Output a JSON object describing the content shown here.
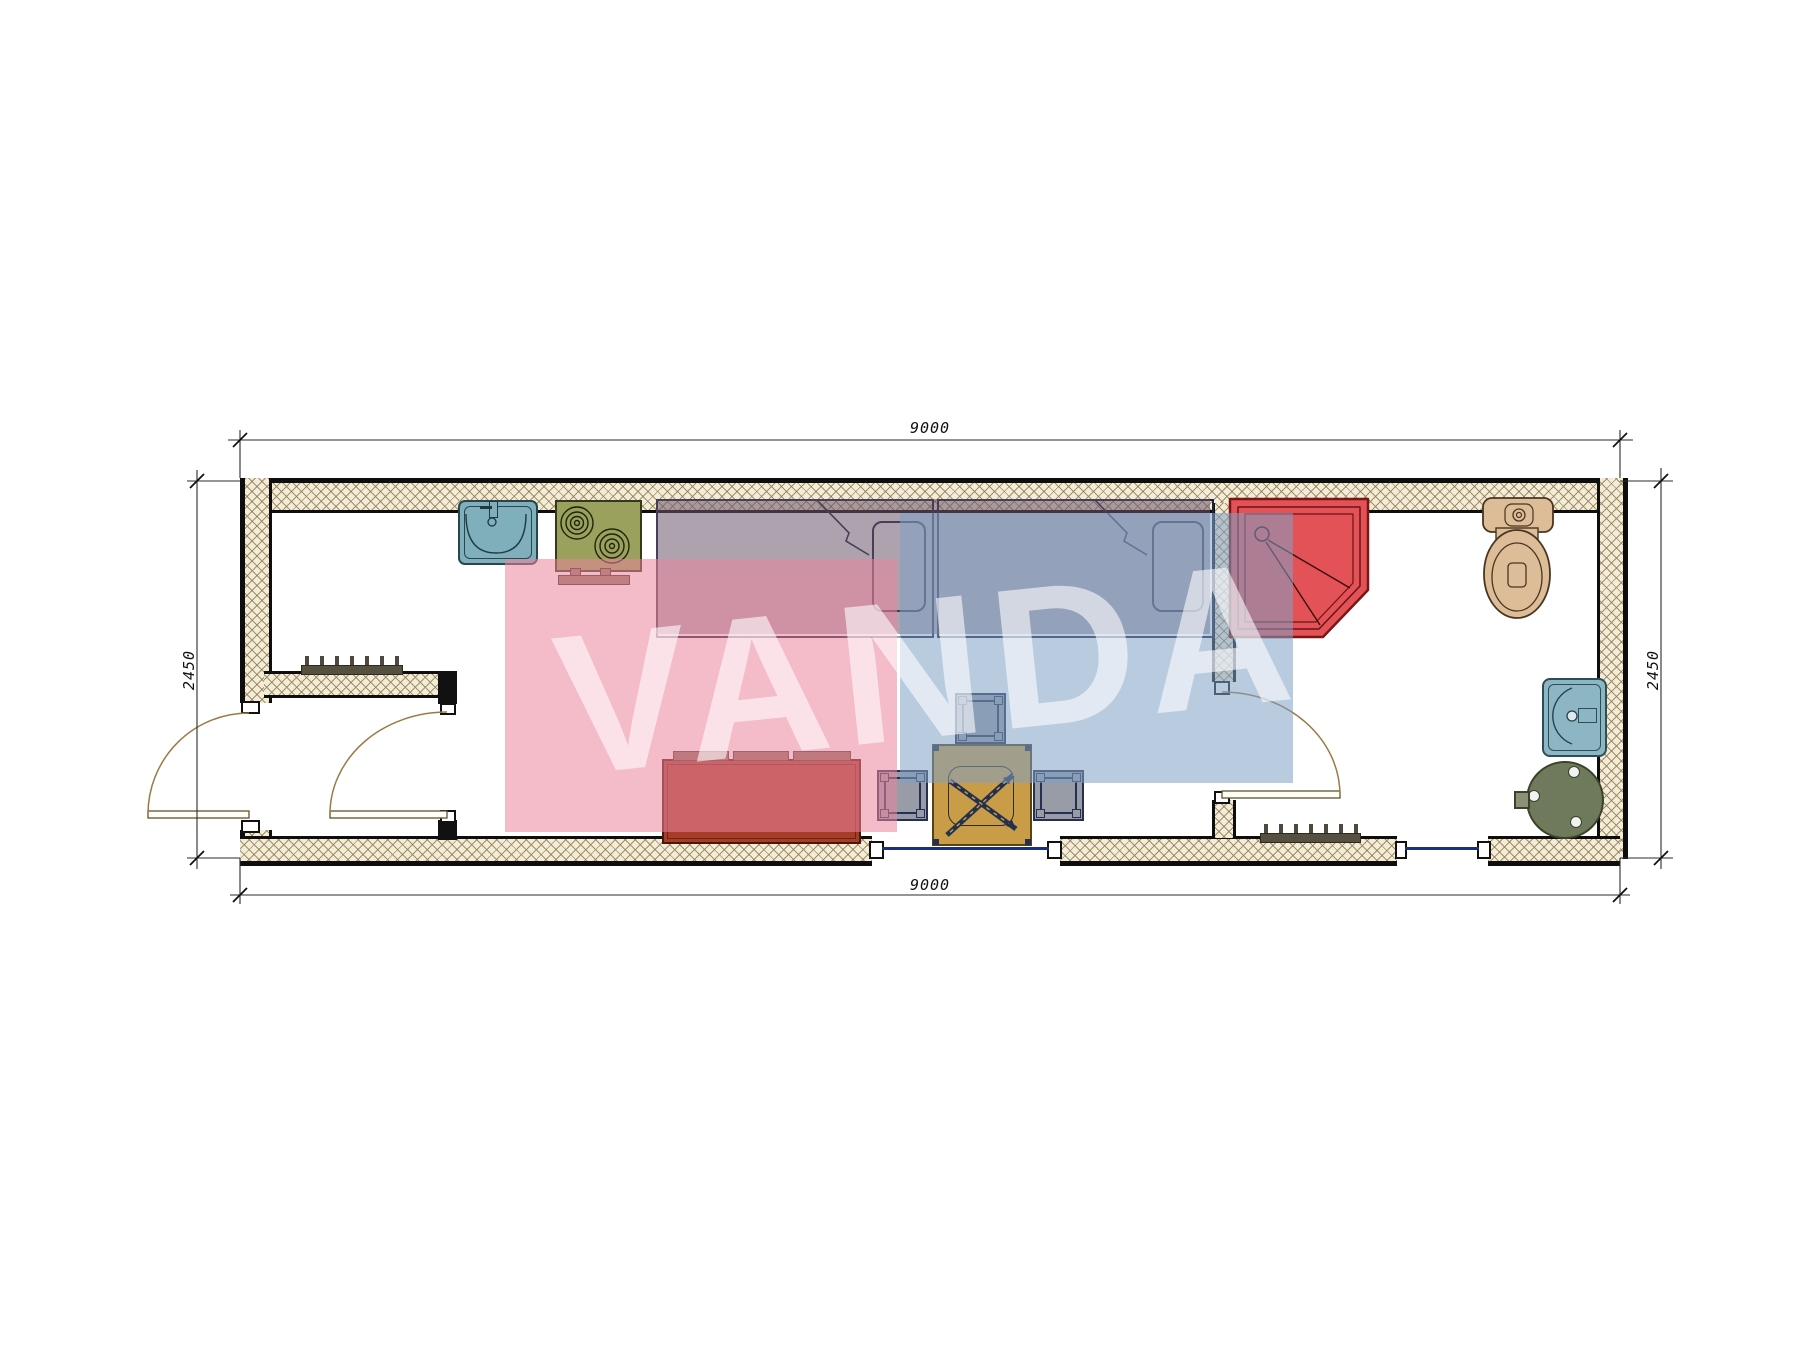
{
  "watermark": {
    "text": "VANDA",
    "pink_color": "#eb839d",
    "blue_color": "#80a0c5"
  },
  "dimensions": {
    "width_top": "9000",
    "width_bottom": "9000",
    "height_left": "2450",
    "height_right": "2450"
  },
  "plan": {
    "type": "container-house-floor-plan",
    "rooms": [
      "entry-hall",
      "kitchen-living-bedroom",
      "bathroom"
    ],
    "furniture": [
      "kitchen-sink",
      "stove-two-burners",
      "single-bed-1",
      "single-bed-2",
      "shower-cabin",
      "toilet",
      "wash-basin",
      "water-heater",
      "sofa",
      "coffee-table-with-fan-symbol",
      "stool-top",
      "stool-left",
      "stool-right",
      "entry-window-grille",
      "south-window-grille",
      "window-1",
      "window-2",
      "entry-exterior-door",
      "entry-interior-door",
      "bathroom-door"
    ],
    "colors": {
      "shower": "#e25257",
      "toilet": "#dcbd98",
      "sink": "#7fafbb",
      "stove": "#9aa15c",
      "sofa": "#a63d28",
      "table": "#c99d47",
      "stool": "#979ca6",
      "heater": "#6f7a5c",
      "bed_overlay": "rgba(107,86,107,0.55)",
      "wall_hatch": "#f3ecd9"
    }
  }
}
